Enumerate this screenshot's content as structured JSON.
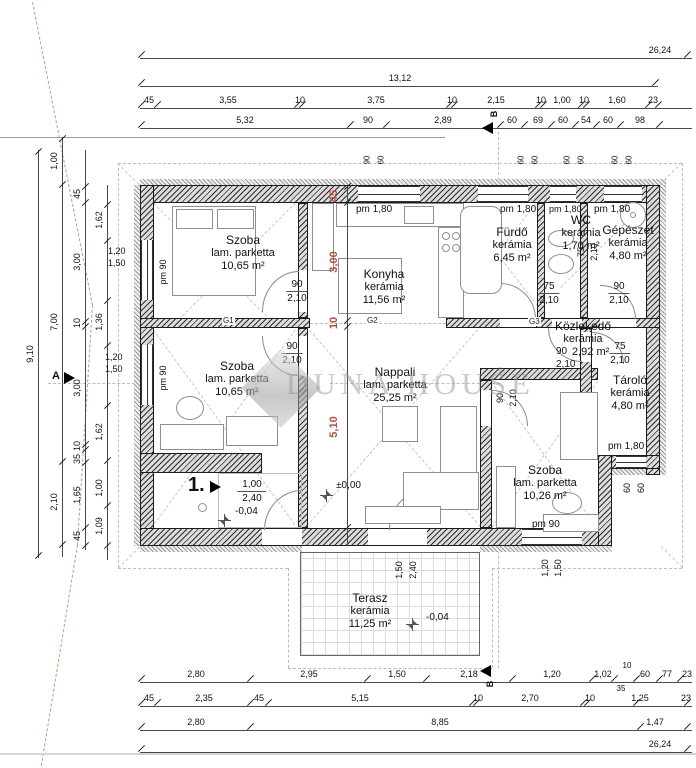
{
  "watermark": {
    "text": "DUNA HOUSE",
    "reg": "®"
  },
  "rooms": [
    {
      "name": "Szoba",
      "floor": "lam. parketta",
      "area": "10,65 m²"
    },
    {
      "name": "Konyha",
      "floor": "kerámia",
      "area": "11,56 m²"
    },
    {
      "name": "Fürdő",
      "floor": "kerámia",
      "area": "6,45 m²"
    },
    {
      "name": "WC",
      "floor": "kerámia",
      "area": "1,70 m²"
    },
    {
      "name": "Gépészet",
      "floor": "kerámia",
      "area": "4,80 m²"
    },
    {
      "name": "Közlekedő",
      "floor": "kerámia",
      "area": "2,92 m²"
    },
    {
      "name": "Tároló",
      "floor": "kerámia",
      "area": "4,80 m²"
    },
    {
      "name": "Szoba",
      "floor": "lam. parketta",
      "area": "10,65 m²"
    },
    {
      "name": "Nappali",
      "floor": "lam. parketta",
      "area": "25,25 m²"
    },
    {
      "name": "Szoba",
      "floor": "lam. parketta",
      "area": "10,26 m²"
    },
    {
      "name": "Terasz",
      "floor": "kerámia",
      "area": "11,25 m²"
    }
  ],
  "doors": [
    {
      "w": "90",
      "h": "2,10"
    },
    {
      "w": "90",
      "h": "2,10"
    },
    {
      "w": "75",
      "h": "2,10"
    },
    {
      "w": "75",
      "h": "2,10"
    },
    {
      "w": "90",
      "h": "2,10"
    },
    {
      "w": "90",
      "h": "2,10"
    },
    {
      "w": "75",
      "h": "2,10"
    },
    {
      "w": "90",
      "h": "2,10"
    },
    {
      "w": "1,00",
      "h": "2,40"
    },
    {
      "w": "1,50",
      "h": "2,40"
    }
  ],
  "labels": {
    "pm90": "pm 90",
    "pm180": "pm 1,80"
  },
  "levels": {
    "zero": "±0,00",
    "minus": "-0,04"
  },
  "markers": {
    "section_a": "A",
    "section_b": "B",
    "entry_no": "1."
  },
  "beams": [
    "G1",
    "G2",
    "G3"
  ],
  "dims": {
    "top": {
      "overall": "26,24",
      "building": "13,12",
      "chain3": [
        "45",
        "3,55",
        "10",
        "3,75",
        "10",
        "2,15",
        "10",
        "1,00",
        "10",
        "1,60",
        "23"
      ],
      "chain4": [
        "5,32",
        "90",
        "2,89",
        "60",
        "69",
        "60",
        "54",
        "60",
        "98"
      ],
      "small": [
        "90",
        "60",
        "60",
        "60",
        "60",
        "60",
        "60",
        "60"
      ]
    },
    "left": {
      "overall": "9,10",
      "chain2": [
        "1,00",
        "7,00",
        "2,10"
      ],
      "chain3": [
        "45",
        "3,00",
        "10",
        "3,00",
        "10",
        "35",
        "1,65",
        "45"
      ],
      "chain4": [
        "1,62",
        "1,36",
        "1,62",
        "1,00",
        "1,09"
      ]
    },
    "mid_red": [
      "45",
      "3,00",
      "10",
      "5,10"
    ],
    "right_small": [
      "60",
      "60"
    ],
    "window_pair": [
      "1,20",
      "1,50"
    ],
    "terrace_door": [
      "1,50",
      "2,40"
    ],
    "bottom": {
      "chain1": [
        "2,80",
        "2,95",
        "1,50",
        "2,18",
        "1,20",
        "1,02",
        "35",
        "10",
        "60",
        "77",
        "23"
      ],
      "chain2": [
        "45",
        "2,35",
        "45",
        "5,15",
        "10",
        "2,70",
        "10",
        "1,25",
        "23"
      ],
      "chain3": [
        "2,80",
        "8,85",
        "1,47"
      ],
      "overall": "26,24"
    }
  }
}
